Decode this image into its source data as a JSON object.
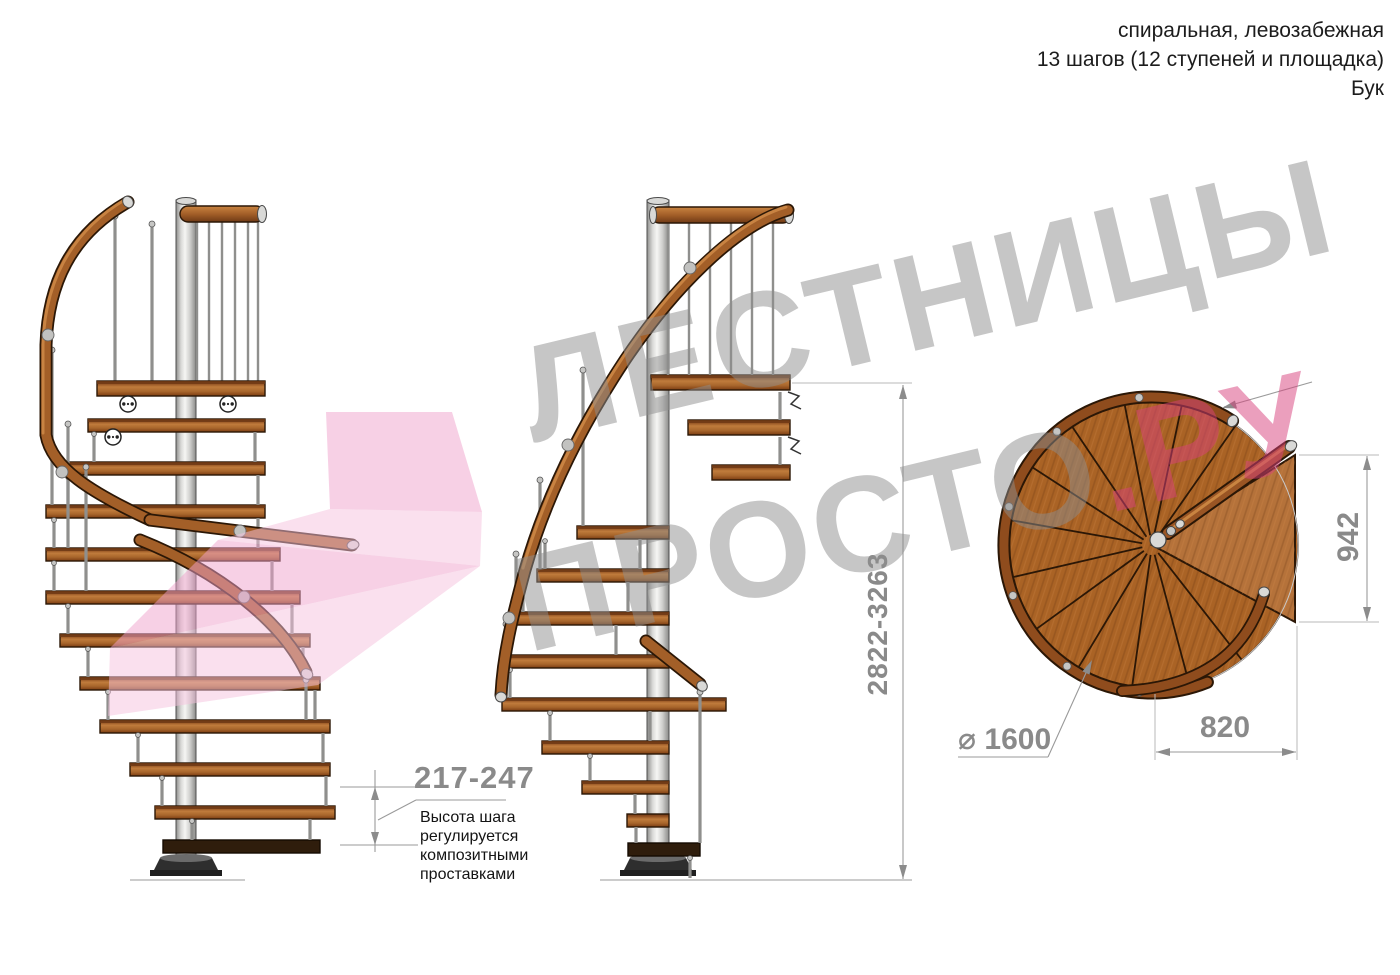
{
  "header": {
    "type_line": "спиральная, левозабежная",
    "steps_line": "13 шагов (12 ступеней и площадка)",
    "material_line": "Бук"
  },
  "dimensions": {
    "total_height_range": "2822-3263",
    "step_height_range": "217-247",
    "step_height_note": "Высота шага\nрегулируется\nкомпозитными\nпроставками",
    "platform_height": "942",
    "platform_width": "820",
    "diameter_label": "⌀ 1600"
  },
  "watermark": {
    "word1": "ЛЕСТНИЦЫ",
    "word2": "ПРОСТО",
    "word2_suffix": ".РУ"
  },
  "colors": {
    "wood_tread": "#a8662c",
    "wood_rail": "#a35f28",
    "wood_plan": "#aa6325",
    "wood_dark_outline": "#2b1706",
    "metal_pole": "#d8d8d6",
    "dimension_gray": "#8a8a8a",
    "watermark_gray": "#8d8d8d",
    "watermark_pink": "#d8407c",
    "arrow_pink": "#f0a2cc"
  }
}
